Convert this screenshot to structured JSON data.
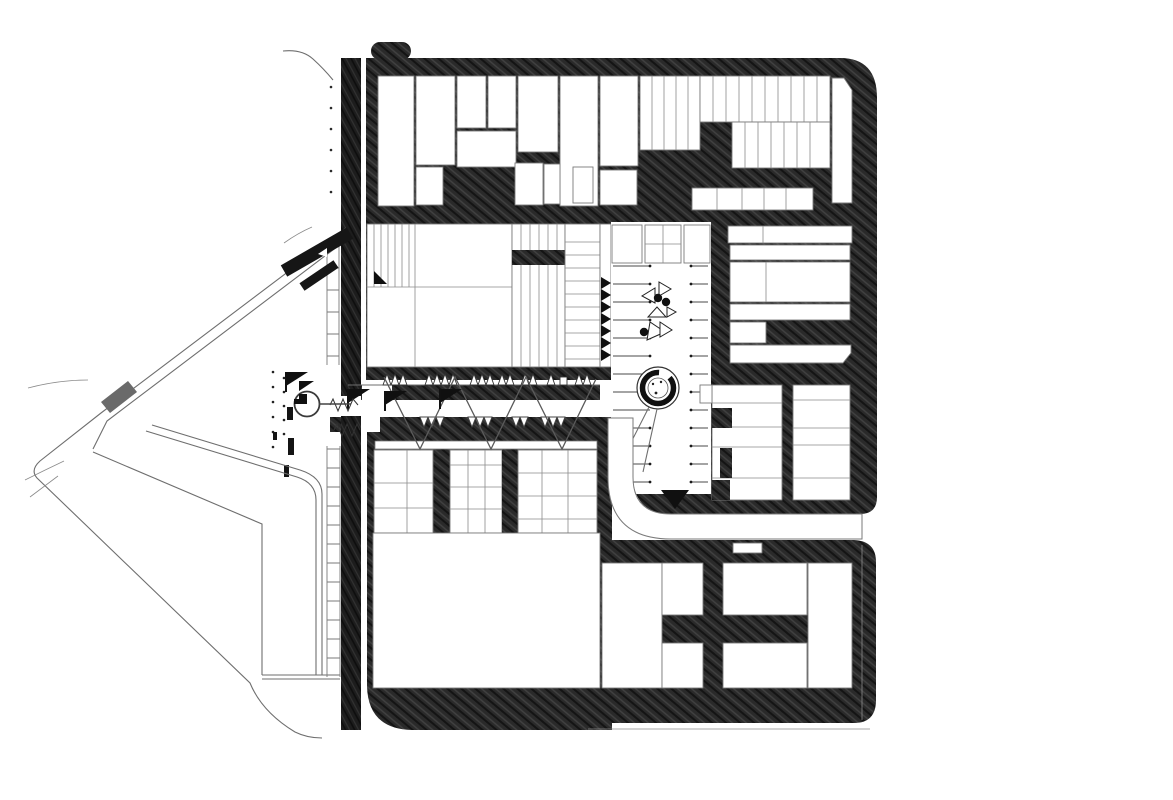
{
  "meta": {
    "drawing_type": "architectural site plan (figure-ground)",
    "technique": "hand-hatched poché city blocks with white building footprints",
    "view": "top-down plan"
  },
  "colors": {
    "paper": "#ffffff",
    "poche": "#282828",
    "poche_dark": "#1c1c1c",
    "solid_ink": "#111111",
    "line": "#6e6e6e",
    "platform_gray": "#6a6a6a"
  },
  "features": {
    "north_block": "North city block with building lots",
    "central_block": "Central block with large hall building",
    "east_block": "East block with courtyard strips",
    "southwest_block": "Southwest block with hall and row houses",
    "southeast_block": "Southeast block with six courtyards",
    "transit_strip": "North-south transit strip",
    "pedestrian_band": "East-west pedestrian band with canopies",
    "parking_lot": "Central parking lot with stalls",
    "fountain": "Circular fountain",
    "sculpture_garden": "Triangle sculpture cluster",
    "plaza_wedge": "Triangular plaza with nested paths",
    "platform": "Gray platform marker on diagonal path",
    "spiral_stair": "Circular stair entrance",
    "ring_road": "Curved service road"
  }
}
